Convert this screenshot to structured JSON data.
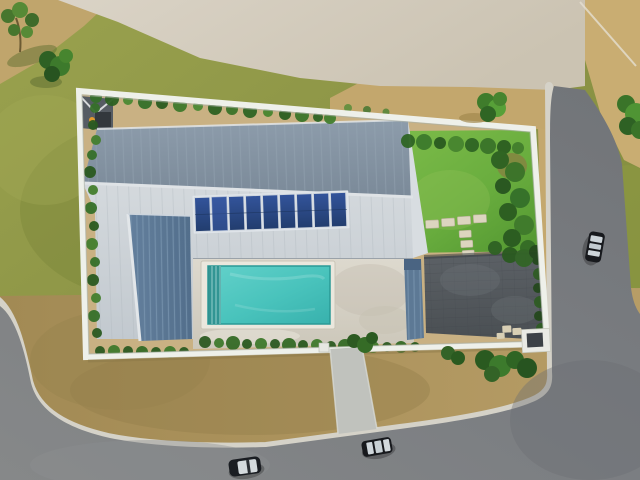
{
  "scene": {
    "title": "Aerial top-down render of a modern house with rooftop solar panels, swimming pool, lawn and walled lot beside two asphalt roads",
    "view": "top-down drone view",
    "house": {
      "roof_main": "gray metal roof, dark north slope and light south slope",
      "solar_panel_count": 9,
      "west_wing_roof": "steel-blue ribbed gable roof",
      "east_canopy": "steel-blue ribbed canopy strip",
      "shed": "small dark shed roof at north-west corner"
    },
    "pool": {
      "shape": "rectangular",
      "water": "turquoise",
      "steps": "slatted steps at west end",
      "deck": "travertine terrace"
    },
    "yard": {
      "lawn": "bright green lawn with stepping stones",
      "stepping_stone_count": 7,
      "hedges": "green hedges along perimeter walls",
      "driveway": "dark charcoal paver court",
      "gate": "white gate at south-east corner",
      "apron": "concrete driveway apron to road"
    },
    "surroundings": {
      "ground": "olive grass and tan dirt",
      "path": "light gravel path across the top",
      "roads": "asphalt road along right side and bottom with light concrete curbs",
      "car_count": 3,
      "cars": [
        "dark car with light roof on right road",
        "dark car with light roof on bottom road",
        "dark car with light roof on bottom road left"
      ],
      "trees": [
        "small tree top-left",
        "bush top-left",
        "round bush above wall",
        "tree at right edge"
      ]
    }
  },
  "palette": {
    "grass_olive": "#8b9345",
    "grass_dark": "#72822f",
    "dirt_tan": "#c3a76e",
    "dirt_brown": "#a38c56",
    "path_light": "#d6cfc1",
    "road_asphalt": "#7a7d81",
    "curb_concrete": "#d5d2c8",
    "wall_white": "#eef0ea",
    "roof_dark": "#8494a3",
    "roof_light": "#ccd3d8",
    "gable_blue": "#5d7894",
    "panel_blue": "#2a4479",
    "pool_water": "#49c3bc",
    "pool_coping": "#eae7dd",
    "deck_travertine": "#d8d4c9",
    "paver_charcoal": "#53585c",
    "apron_concrete": "#c0c2bd",
    "hedge_green": "#2f6524",
    "lawn_green": "#69ad3e",
    "car_body": "#17191d",
    "car_roof": "#ced5da",
    "orange_accent": "#e2992b"
  }
}
